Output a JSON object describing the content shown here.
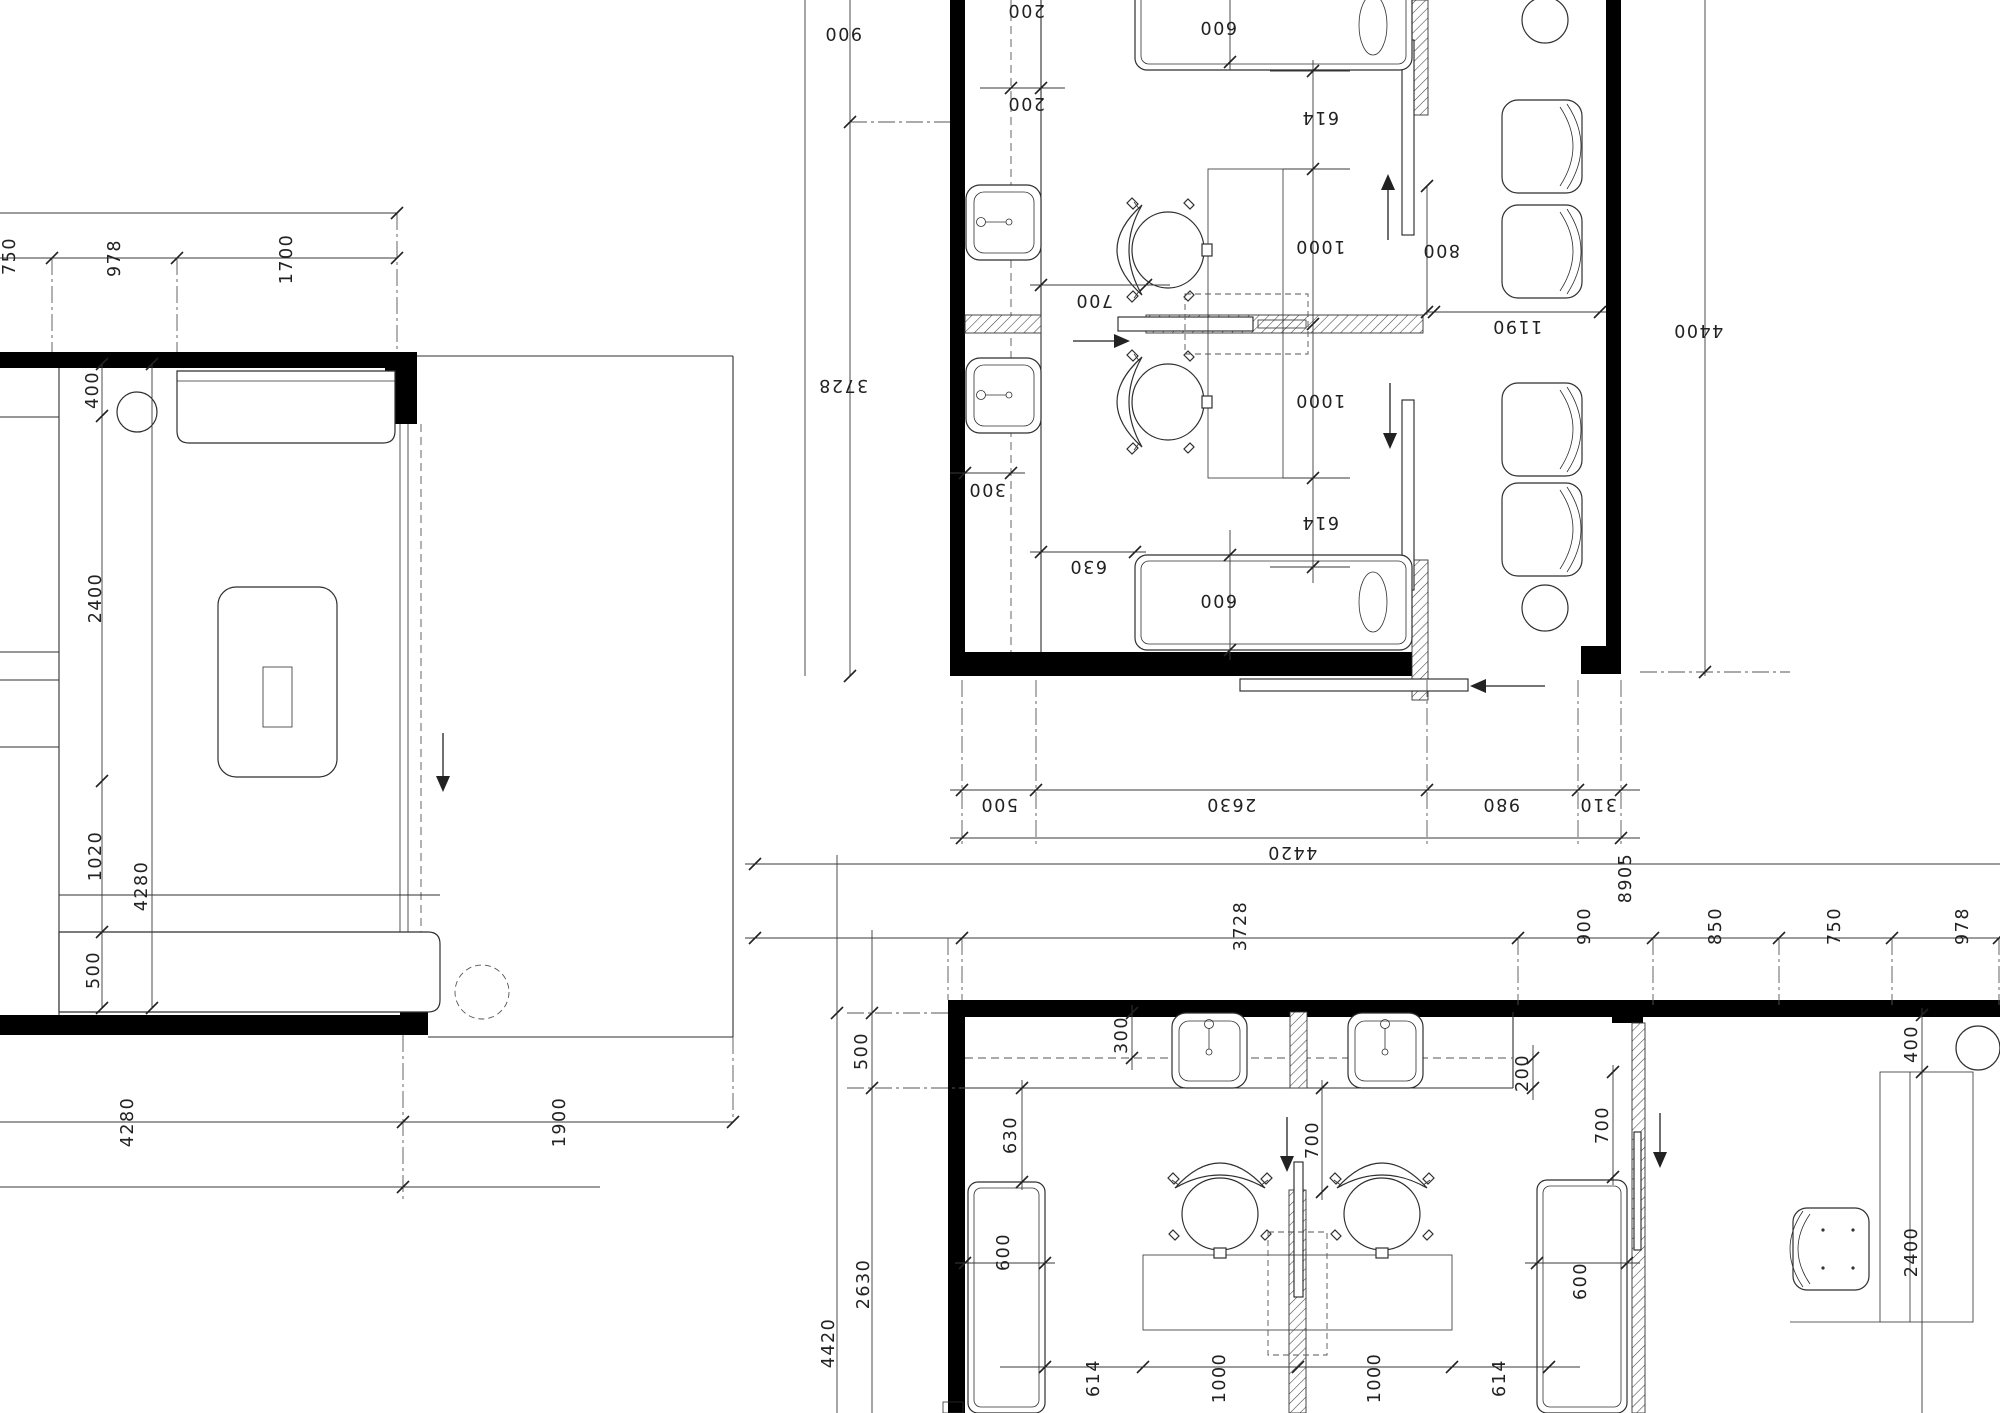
{
  "document": {
    "type": "architectural-floor-plan",
    "background_color": "#ffffff",
    "line_color": "#2f2f2f",
    "wall_color": "#000000",
    "units": "millimeters"
  },
  "plans": {
    "plan_top_left": {
      "description": "room plan upper left, dimension text rotated 90",
      "labels": [
        {
          "t": "750",
          "x": 10,
          "y": 256,
          "r": -90
        },
        {
          "t": "978",
          "x": 115,
          "y": 258,
          "r": -90
        },
        {
          "t": "1700",
          "x": 287,
          "y": 259,
          "r": -90
        },
        {
          "t": "400",
          "x": 93,
          "y": 390,
          "r": -90
        },
        {
          "t": "2400",
          "x": 96,
          "y": 598,
          "r": -90
        },
        {
          "t": "1020",
          "x": 96,
          "y": 856,
          "r": -90
        },
        {
          "t": "500",
          "x": 94,
          "y": 970,
          "r": -90
        },
        {
          "t": "4280",
          "x": 142,
          "y": 886,
          "r": -90
        },
        {
          "t": "4280",
          "x": 128,
          "y": 1122,
          "r": -90
        },
        {
          "t": "1900",
          "x": 560,
          "y": 1122,
          "r": -90
        }
      ]
    },
    "plan_top_right": {
      "description": "double treatment room, drawn rotated 180, text upside down",
      "labels": [
        {
          "t": "900",
          "x": 843,
          "y": 33,
          "r": 180
        },
        {
          "t": "3728",
          "x": 843,
          "y": 385,
          "r": 180
        },
        {
          "t": "200",
          "x": 1026,
          "y": 10,
          "r": 180
        },
        {
          "t": "200",
          "x": 1026,
          "y": 103,
          "r": 180
        },
        {
          "t": "600",
          "x": 1218,
          "y": 27,
          "r": 180
        },
        {
          "t": "614",
          "x": 1320,
          "y": 117,
          "r": 180
        },
        {
          "t": "1000",
          "x": 1320,
          "y": 246,
          "r": 180
        },
        {
          "t": "700",
          "x": 1094,
          "y": 300,
          "r": 180
        },
        {
          "t": "800",
          "x": 1441,
          "y": 250,
          "r": 180
        },
        {
          "t": "1190",
          "x": 1517,
          "y": 326,
          "r": 180
        },
        {
          "t": "4400",
          "x": 1698,
          "y": 330,
          "r": 180
        },
        {
          "t": "300",
          "x": 987,
          "y": 489,
          "r": 180
        },
        {
          "t": "1000",
          "x": 1320,
          "y": 400,
          "r": 180
        },
        {
          "t": "614",
          "x": 1320,
          "y": 522,
          "r": 180
        },
        {
          "t": "630",
          "x": 1088,
          "y": 566,
          "r": 180
        },
        {
          "t": "600",
          "x": 1218,
          "y": 600,
          "r": 180
        },
        {
          "t": "500",
          "x": 999,
          "y": 804,
          "r": 180
        },
        {
          "t": "2630",
          "x": 1231,
          "y": 804,
          "r": 180
        },
        {
          "t": "980",
          "x": 1501,
          "y": 804,
          "r": 180
        },
        {
          "t": "310",
          "x": 1598,
          "y": 804,
          "r": 180
        },
        {
          "t": "4420",
          "x": 1292,
          "y": 852,
          "r": 180
        }
      ]
    },
    "plan_bottom": {
      "description": "double treatment room, upright orientation, text rotated 90",
      "labels": [
        {
          "t": "8905",
          "x": 1626,
          "y": 878,
          "r": -90
        },
        {
          "t": "3728",
          "x": 1241,
          "y": 926,
          "r": -90
        },
        {
          "t": "900",
          "x": 1585,
          "y": 926,
          "r": -90
        },
        {
          "t": "850",
          "x": 1716,
          "y": 926,
          "r": -90
        },
        {
          "t": "750",
          "x": 1835,
          "y": 926,
          "r": -90
        },
        {
          "t": "978",
          "x": 1963,
          "y": 926,
          "r": -90
        },
        {
          "t": "500",
          "x": 862,
          "y": 1051,
          "r": -90
        },
        {
          "t": "300",
          "x": 1122,
          "y": 1035,
          "r": -90
        },
        {
          "t": "200",
          "x": 1523,
          "y": 1073,
          "r": -90
        },
        {
          "t": "400",
          "x": 1912,
          "y": 1044,
          "r": -90
        },
        {
          "t": "700",
          "x": 1313,
          "y": 1140,
          "r": -90
        },
        {
          "t": "700",
          "x": 1603,
          "y": 1125,
          "r": -90
        },
        {
          "t": "630",
          "x": 1011,
          "y": 1135,
          "r": -90
        },
        {
          "t": "600",
          "x": 1004,
          "y": 1252,
          "r": -90
        },
        {
          "t": "600",
          "x": 1581,
          "y": 1281,
          "r": -90
        },
        {
          "t": "2630",
          "x": 864,
          "y": 1284,
          "r": -90
        },
        {
          "t": "4420",
          "x": 829,
          "y": 1343,
          "r": -90
        },
        {
          "t": "2400",
          "x": 1912,
          "y": 1252,
          "r": -90
        },
        {
          "t": "614",
          "x": 1094,
          "y": 1378,
          "r": -90
        },
        {
          "t": "1000",
          "x": 1220,
          "y": 1378,
          "r": -90
        },
        {
          "t": "1000",
          "x": 1375,
          "y": 1378,
          "r": -90
        },
        {
          "t": "614",
          "x": 1500,
          "y": 1378,
          "r": -90
        }
      ]
    }
  }
}
